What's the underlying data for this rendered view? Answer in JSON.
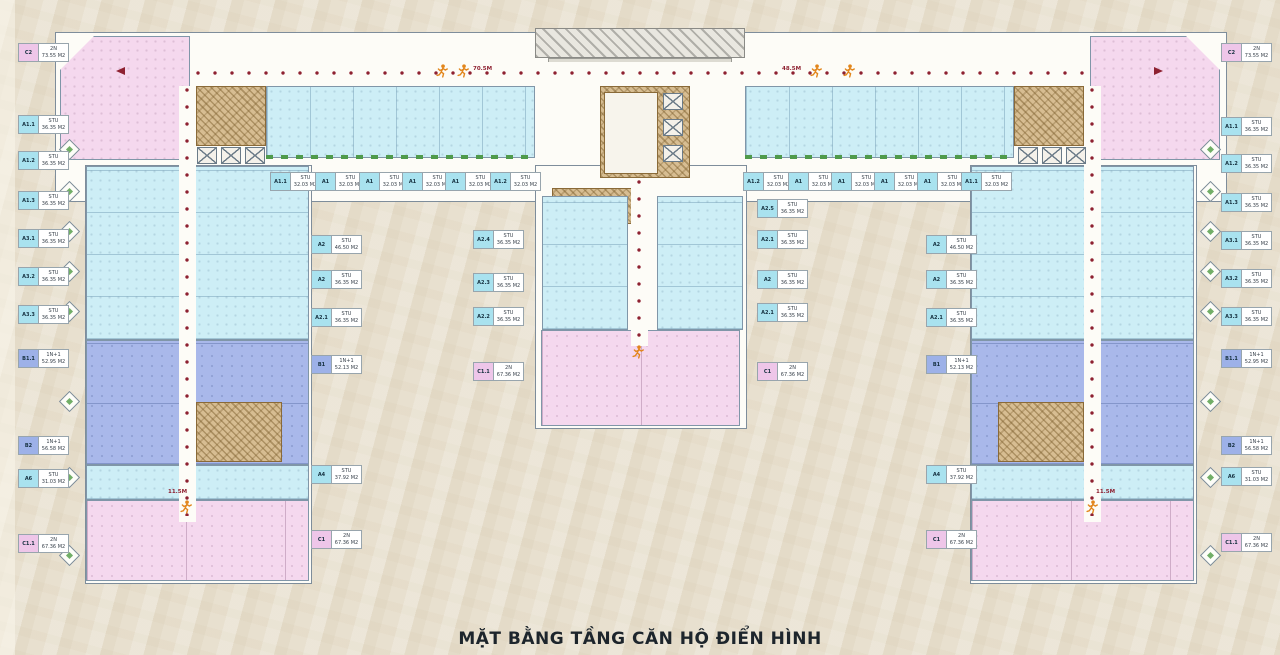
{
  "title": "MẶT BẰNG TẦNG CĂN HỘ ĐIỂN HÌNH",
  "colors": {
    "studio_chip": "#a9e2ef",
    "one_bed_chip": "#9db1e8",
    "two_bed_chip": "#eec6e9",
    "studio_fill": "#cdeef6",
    "one_bed_fill": "#a9b8ea",
    "two_bed_fill": "#f5d8ee",
    "core_fill": "#d7bd92",
    "corridor_dot": "#8e2131",
    "runner": "#e2861c"
  },
  "plan": {
    "chips": [
      {
        "code": "C2",
        "type": "2N",
        "area": "73.55 M2",
        "x": 19,
        "y": 44
      },
      {
        "code": "A1.1",
        "type": "STU",
        "area": "36.35 M2",
        "x": 19,
        "y": 116
      },
      {
        "code": "A1.2",
        "type": "STU",
        "area": "36.35 M2",
        "x": 19,
        "y": 152
      },
      {
        "code": "A1.3",
        "type": "STU",
        "area": "36.35 M2",
        "x": 19,
        "y": 192
      },
      {
        "code": "A3.1",
        "type": "STU",
        "area": "36.35 M2",
        "x": 19,
        "y": 230
      },
      {
        "code": "A3.2",
        "type": "STU",
        "area": "36.35 M2",
        "x": 19,
        "y": 268
      },
      {
        "code": "A3.3",
        "type": "STU",
        "area": "36.35 M2",
        "x": 19,
        "y": 306
      },
      {
        "code": "B1.1",
        "type": "1N+1",
        "area": "52.95 M2",
        "x": 19,
        "y": 350
      },
      {
        "code": "B2",
        "type": "1N+1",
        "area": "56.58 M2",
        "x": 19,
        "y": 437
      },
      {
        "code": "A6",
        "type": "STU",
        "area": "31.03 M2",
        "x": 19,
        "y": 470
      },
      {
        "code": "C1.1",
        "type": "2N",
        "area": "67.36 M2",
        "x": 19,
        "y": 535
      },
      {
        "code": "C2",
        "type": "2N",
        "area": "73.55 M2",
        "x": 1222,
        "y": 44
      },
      {
        "code": "A1.1",
        "type": "STU",
        "area": "36.35 M2",
        "x": 1222,
        "y": 118
      },
      {
        "code": "A1.2",
        "type": "STU",
        "area": "36.35 M2",
        "x": 1222,
        "y": 155
      },
      {
        "code": "A1.3",
        "type": "STU",
        "area": "36.35 M2",
        "x": 1222,
        "y": 194
      },
      {
        "code": "A3.1",
        "type": "STU",
        "area": "36.35 M2",
        "x": 1222,
        "y": 232
      },
      {
        "code": "A3.2",
        "type": "STU",
        "area": "36.35 M2",
        "x": 1222,
        "y": 270
      },
      {
        "code": "A3.3",
        "type": "STU",
        "area": "36.35 M2",
        "x": 1222,
        "y": 308
      },
      {
        "code": "B1.1",
        "type": "1N+1",
        "area": "52.95 M2",
        "x": 1222,
        "y": 350
      },
      {
        "code": "B2",
        "type": "1N+1",
        "area": "56.58 M2",
        "x": 1222,
        "y": 437
      },
      {
        "code": "A6",
        "type": "STU",
        "area": "31.03 M2",
        "x": 1222,
        "y": 468
      },
      {
        "code": "C1.1",
        "type": "2N",
        "area": "67.36 M2",
        "x": 1222,
        "y": 534
      },
      {
        "code": "A1.1",
        "type": "STU",
        "area": "32.03 M2",
        "x": 271,
        "y": 173
      },
      {
        "code": "A1",
        "type": "STU",
        "area": "32.03 M2",
        "x": 316,
        "y": 173
      },
      {
        "code": "A1",
        "type": "STU",
        "area": "32.03 M2",
        "x": 360,
        "y": 173
      },
      {
        "code": "A1",
        "type": "STU",
        "area": "32.03 M2",
        "x": 403,
        "y": 173
      },
      {
        "code": "A1",
        "type": "STU",
        "area": "32.03 M2",
        "x": 446,
        "y": 173
      },
      {
        "code": "A1.2",
        "type": "STU",
        "area": "32.03 M2",
        "x": 491,
        "y": 173
      },
      {
        "code": "A1.2",
        "type": "STU",
        "area": "32.03 M2",
        "x": 744,
        "y": 173
      },
      {
        "code": "A1",
        "type": "STU",
        "area": "32.03 M2",
        "x": 789,
        "y": 173
      },
      {
        "code": "A1",
        "type": "STU",
        "area": "32.03 M2",
        "x": 832,
        "y": 173
      },
      {
        "code": "A1",
        "type": "STU",
        "area": "32.03 M2",
        "x": 875,
        "y": 173
      },
      {
        "code": "A1",
        "type": "STU",
        "area": "32.03 M2",
        "x": 918,
        "y": 173
      },
      {
        "code": "A1.1",
        "type": "STU",
        "area": "32.03 M2",
        "x": 962,
        "y": 173
      },
      {
        "code": "A2.4",
        "type": "STU",
        "area": "36.35 M2",
        "x": 474,
        "y": 231
      },
      {
        "code": "A2.3",
        "type": "STU",
        "area": "36.35 M2",
        "x": 474,
        "y": 274
      },
      {
        "code": "A2.2",
        "type": "STU",
        "area": "36.35 M2",
        "x": 474,
        "y": 308
      },
      {
        "code": "C1.1",
        "type": "2N",
        "area": "67.36 M2",
        "x": 474,
        "y": 363
      },
      {
        "code": "A2.5",
        "type": "STU",
        "area": "36.35 M2",
        "x": 758,
        "y": 200
      },
      {
        "code": "A2.1",
        "type": "STU",
        "area": "36.35 M2",
        "x": 758,
        "y": 231
      },
      {
        "code": "A2",
        "type": "STU",
        "area": "36.35 M2",
        "x": 758,
        "y": 271
      },
      {
        "code": "A2.1",
        "type": "STU",
        "area": "36.35 M2",
        "x": 758,
        "y": 304
      },
      {
        "code": "C1",
        "type": "2N",
        "area": "67.36 M2",
        "x": 758,
        "y": 363
      },
      {
        "code": "A2",
        "type": "STU",
        "area": "46.50 M2",
        "x": 312,
        "y": 236
      },
      {
        "code": "A2",
        "type": "STU",
        "area": "36.35 M2",
        "x": 312,
        "y": 271
      },
      {
        "code": "A2.1",
        "type": "STU",
        "area": "36.35 M2",
        "x": 312,
        "y": 309
      },
      {
        "code": "B1",
        "type": "1N+1",
        "area": "52.13 M2",
        "x": 312,
        "y": 356
      },
      {
        "code": "A4",
        "type": "STU",
        "area": "37.92 M2",
        "x": 312,
        "y": 466
      },
      {
        "code": "C1",
        "type": "2N",
        "area": "67.36 M2",
        "x": 312,
        "y": 531
      },
      {
        "code": "A2",
        "type": "STU",
        "area": "46.50 M2",
        "x": 927,
        "y": 236
      },
      {
        "code": "A2",
        "type": "STU",
        "area": "36.35 M2",
        "x": 927,
        "y": 271
      },
      {
        "code": "A2.1",
        "type": "STU",
        "area": "36.35 M2",
        "x": 927,
        "y": 309
      },
      {
        "code": "B1",
        "type": "1N+1",
        "area": "52.13 M2",
        "x": 927,
        "y": 356
      },
      {
        "code": "A4",
        "type": "STU",
        "area": "37.92 M2",
        "x": 927,
        "y": 466
      },
      {
        "code": "C1",
        "type": "2N",
        "area": "67.36 M2",
        "x": 927,
        "y": 531
      }
    ],
    "corridor_labels": [
      {
        "text": "70.5M",
        "x": 473,
        "y": 66
      },
      {
        "text": "48.5M",
        "x": 782,
        "y": 66
      },
      {
        "text": "11.5M",
        "x": 168,
        "y": 489
      },
      {
        "text": "11.5M",
        "x": 1096,
        "y": 489
      }
    ],
    "decor": {
      "bays": {
        "left_x": 62,
        "right_x": 1203,
        "ys": [
          142,
          184,
          224,
          264,
          304,
          394,
          470,
          548
        ]
      },
      "lifts": [
        [
          197,
          147
        ],
        [
          221,
          147
        ],
        [
          245,
          147
        ],
        [
          1018,
          147
        ],
        [
          1042,
          147
        ],
        [
          1066,
          147
        ],
        [
          663,
          93
        ],
        [
          663,
          119
        ],
        [
          663,
          145
        ]
      ],
      "runners": [
        [
          436,
          63
        ],
        [
          457,
          63
        ],
        [
          810,
          63
        ],
        [
          843,
          63
        ],
        [
          180,
          499
        ],
        [
          1086,
          499
        ],
        [
          632,
          344
        ]
      ],
      "arrows": [
        {
          "x": 116,
          "y": 67,
          "dir": "left"
        },
        {
          "x": 1154,
          "y": 67,
          "dir": "right"
        }
      ],
      "corridor_dots": [
        {
          "dir": "h",
          "x": 196,
          "y": 71,
          "len": 888
        },
        {
          "dir": "v",
          "x": 185,
          "y": 88,
          "len": 428
        },
        {
          "dir": "v",
          "x": 1090,
          "y": 88,
          "len": 428
        },
        {
          "dir": "v",
          "x": 637,
          "y": 180,
          "len": 162
        }
      ]
    }
  }
}
